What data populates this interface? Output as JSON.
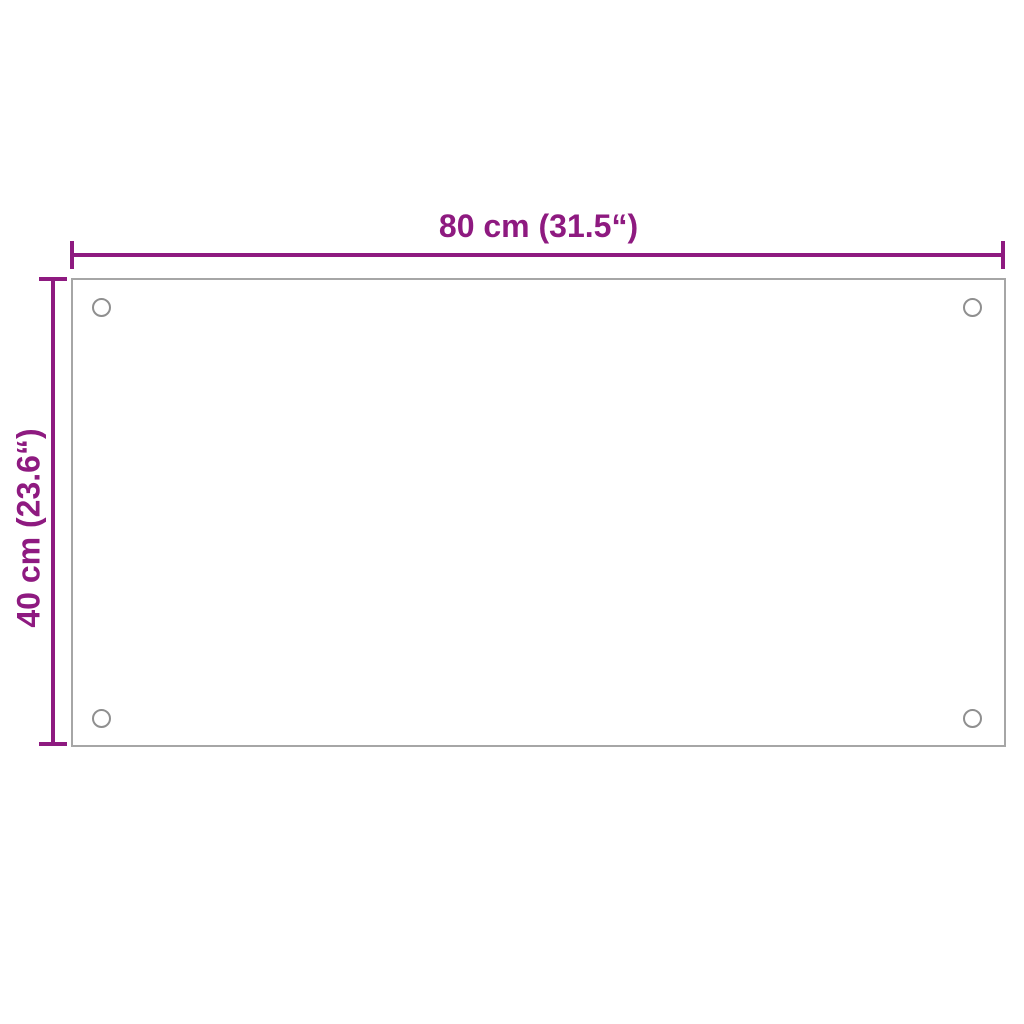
{
  "diagram": {
    "width_label": "80 cm (31.5“)",
    "height_label": "40 cm (23.6“)",
    "panel": {
      "shape": "rectangle",
      "mounting_holes": 4
    }
  },
  "colors": {
    "dimension_accent": "#8E1A80",
    "panel_border": "#A6A6A6",
    "hole_border": "#8F8F8F",
    "background": "#FFFFFF"
  }
}
